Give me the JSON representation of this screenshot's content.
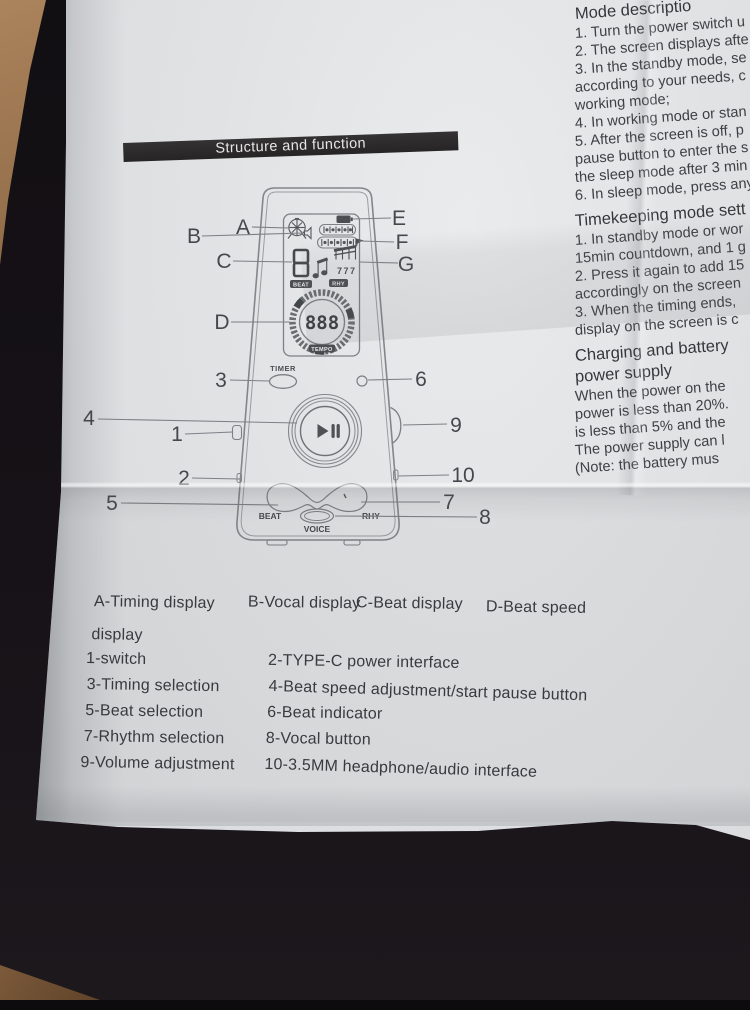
{
  "banner": {
    "title": "Structure and function"
  },
  "mode_text": {
    "heading": "Mode descriptio",
    "lines": [
      "1. Turn the power switch u",
      "2. The screen displays afte",
      "3. In the standby mode, se",
      "according to your needs, c",
      "working mode;",
      "4. In working mode or stan",
      "5. After the screen is off, p",
      "pause button to enter the s",
      "the sleep mode after 3 min",
      "6. In sleep mode, press any"
    ]
  },
  "timekeeping_text": {
    "heading": "Timekeeping mode sett",
    "lines": [
      "1. In standby mode or wor",
      "15min countdown, and 1 g",
      "2. Press it again to add 15",
      "accordingly on the screen",
      "3. When the timing ends,",
      "display on the screen is c"
    ]
  },
  "charging_text": {
    "heading_line1": "Charging and battery",
    "heading_line2": "power supply",
    "lines": [
      "When the power on the",
      "power is less than 20%.",
      "is less than 5% and the",
      "The power supply can l",
      "(Note: the battery mus"
    ]
  },
  "device": {
    "callouts": {
      "A": "A",
      "B": "B",
      "C": "C",
      "D": "D",
      "E": "E",
      "F": "F",
      "G": "G",
      "n1": "1",
      "n2": "2",
      "n3": "3",
      "n4": "4",
      "n5": "5",
      "n6": "6",
      "n7": "7",
      "n8": "8",
      "n9": "9",
      "n10": "10"
    },
    "screen": {
      "beat_digit_tag": "BEAT",
      "rhy_tag": "RHY",
      "tempo_digits": "888",
      "tempo_tag": "TEMPO",
      "sub_rhythm": "777"
    },
    "labels": {
      "timer": "TIMER",
      "beat": "BEAT",
      "rhy": "RHY",
      "voice": "VOICE"
    }
  },
  "legend": {
    "row_a": [
      "A-Timing display",
      "B-Vocal display",
      "C-Beat display",
      "D-Beat speed"
    ],
    "row_a_wrap": "display",
    "col1": [
      "1-switch",
      "3-Timing selection",
      "5-Beat selection",
      "7-Rhythm selection",
      "9-Volume adjustment"
    ],
    "col2": [
      "2-TYPE-C power interface",
      "4-Beat speed adjustment/start pause button",
      "6-Beat indicator",
      "8-Vocal button",
      "10-3.5MM headphone/audio interface"
    ]
  },
  "colors": {
    "paper": "#dfe1e3",
    "banner_bg": "#2c2a2b",
    "ink": "#3e4044",
    "line_art": "#7d8084",
    "background": "#120f13",
    "wood": "#9c7550"
  }
}
